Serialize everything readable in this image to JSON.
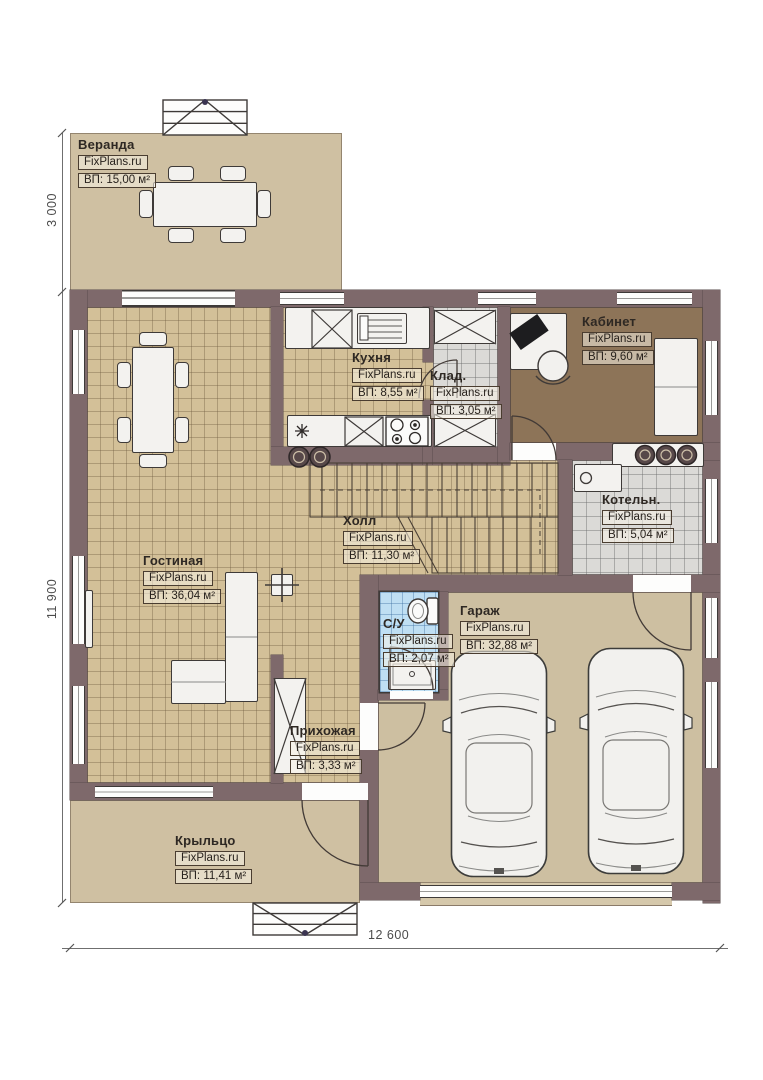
{
  "brand": "FixPlans.ru",
  "rooms": {
    "veranda": {
      "name": "Веранда",
      "area": "ВП: 15,00 м²"
    },
    "kitchen": {
      "name": "Кухня",
      "area": "ВП: 8,55 м²"
    },
    "storage": {
      "name": "Клад.",
      "area": "ВП: 3,05 м²"
    },
    "office": {
      "name": "Кабинет",
      "area": "ВП: 9,60 м²"
    },
    "boiler": {
      "name": "Котельн.",
      "area": "ВП: 5,04 м²"
    },
    "hall": {
      "name": "Холл",
      "area": "ВП: 11,30 м²"
    },
    "living": {
      "name": "Гостиная",
      "area": "ВП: 36,04 м²"
    },
    "bathroom": {
      "name": "С/У",
      "area": "ВП: 2,07 м²"
    },
    "garage": {
      "name": "Гараж",
      "area": "ВП: 32,88 м²"
    },
    "entry": {
      "name": "Прихожая",
      "area": "ВП: 3,33 м²"
    },
    "porch": {
      "name": "Крыльцо",
      "area": "ВП: 11,41 м²"
    }
  },
  "dimensions": {
    "veranda_depth": "3 000",
    "house_depth": "11 900",
    "house_width": "12 600"
  },
  "colors": {
    "wall": "#7e696b",
    "floor_tile": "#d3c098",
    "floor_plain": "#cfc0a2",
    "floor_gray": "#dbdad7",
    "floor_blue": "#bfdff3",
    "floor_office": "#8d7458"
  }
}
